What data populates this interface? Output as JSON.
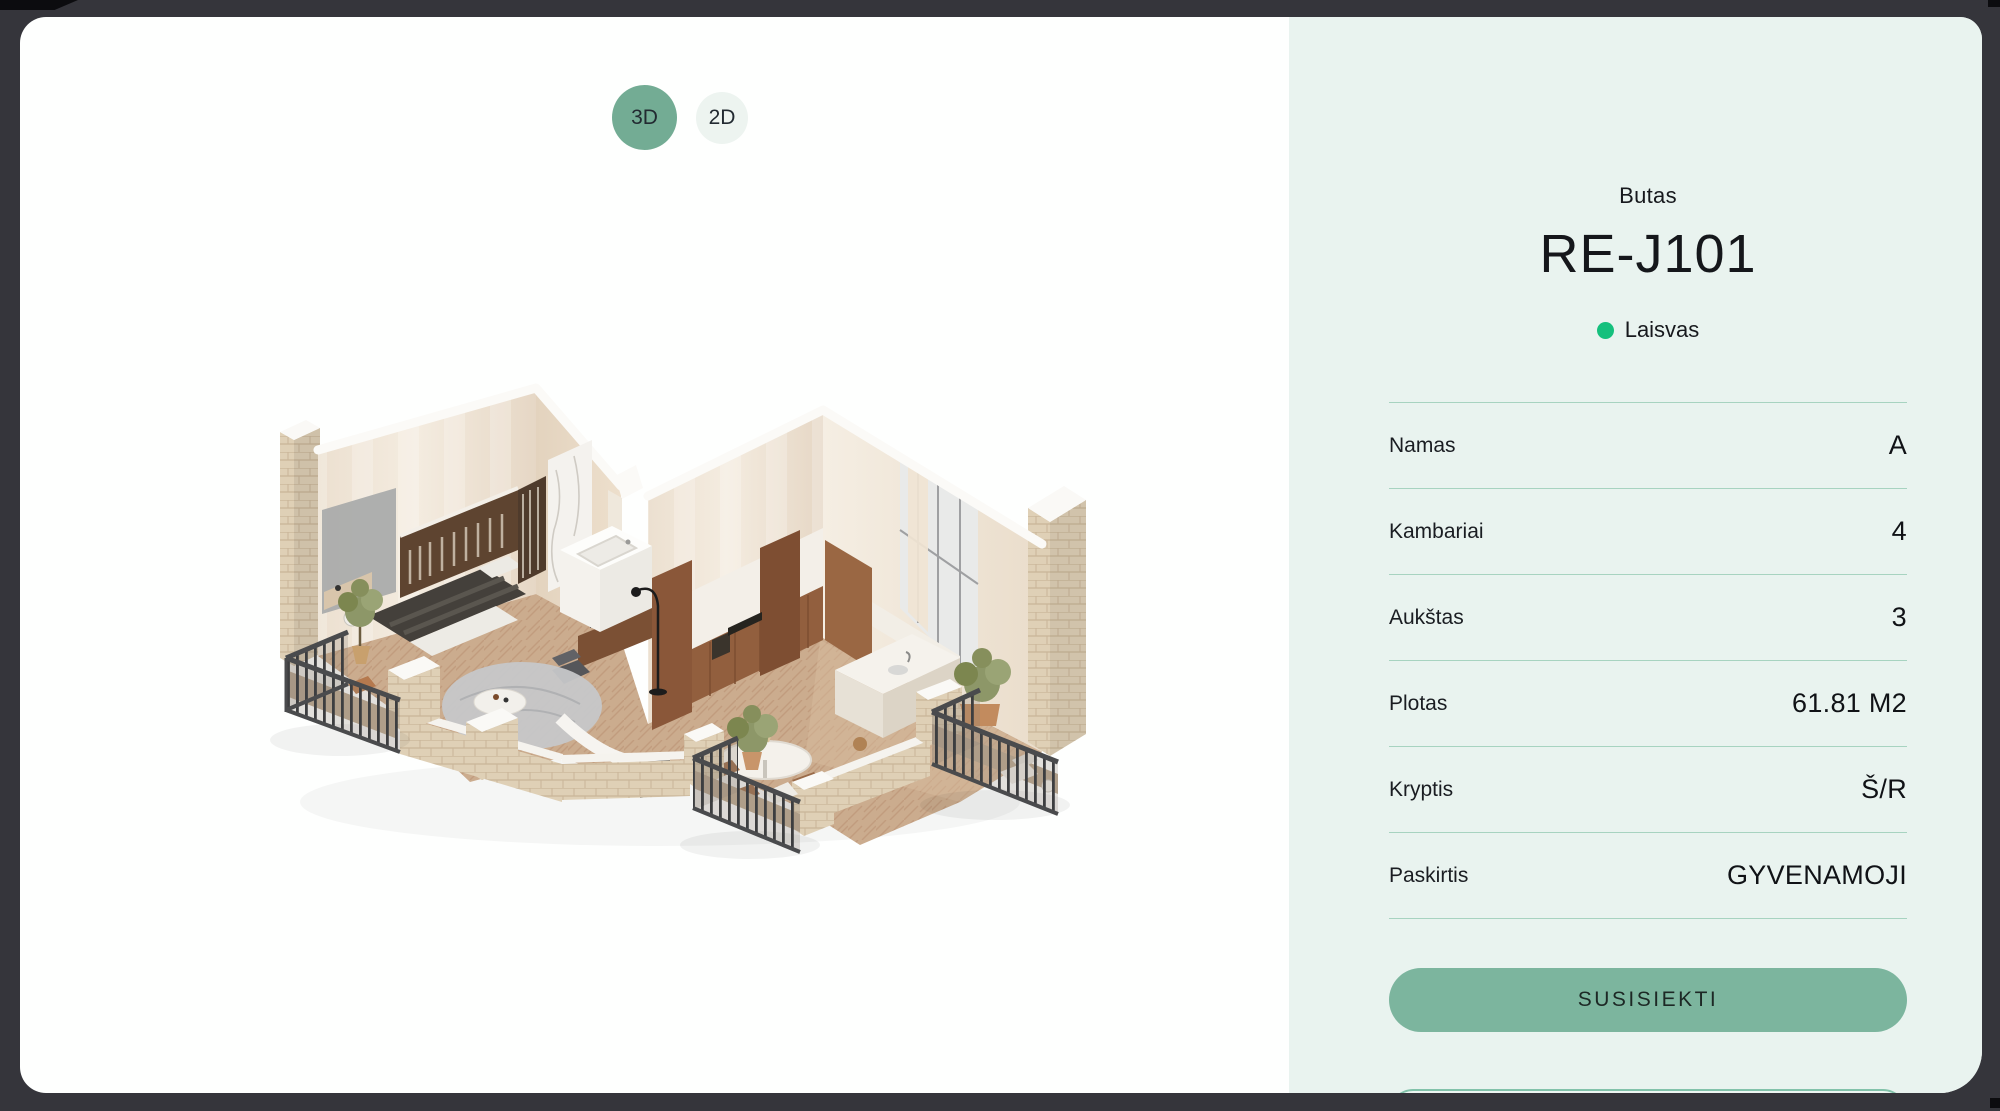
{
  "frame": {
    "background": "#35353B"
  },
  "viewer": {
    "toggle_3d_label": "3D",
    "toggle_2d_label": "2D",
    "floorplan_description": "isometric-3d-apartment-floorplan"
  },
  "panel": {
    "background": "#E9F3EF",
    "subtitle": "Butas",
    "title": "RE-J101",
    "status": {
      "label": "Laisvas",
      "color": "#15C07D"
    },
    "details": [
      {
        "label": "Namas",
        "value": "A"
      },
      {
        "label": "Kambariai",
        "value": "4"
      },
      {
        "label": "Aukštas",
        "value": "3"
      },
      {
        "label": "Plotas",
        "value": "61.81 M2"
      },
      {
        "label": "Kryptis",
        "value": "Š/R"
      },
      {
        "label": "Paskirtis",
        "value": "GYVENAMOJI"
      }
    ],
    "cta_label": "SUSISIEKTI",
    "accent_colors": {
      "button": "#7CB59E",
      "divider": "#A7D3C0",
      "toggle_active": "#73AC94"
    }
  }
}
